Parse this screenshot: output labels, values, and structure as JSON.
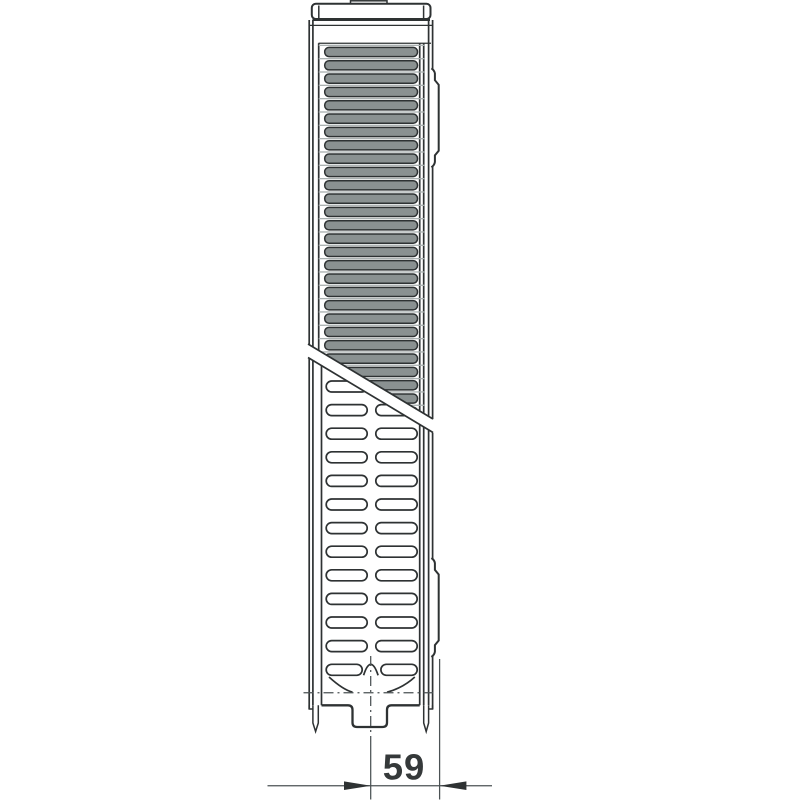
{
  "dimension": {
    "value": "59"
  },
  "colors": {
    "line": "#2e3233",
    "thin_line": "#4b5254",
    "fin_fill": "#8a9191",
    "gap_line": "#a9b0b0",
    "text": "#35393a",
    "surface": "#ffffff"
  }
}
